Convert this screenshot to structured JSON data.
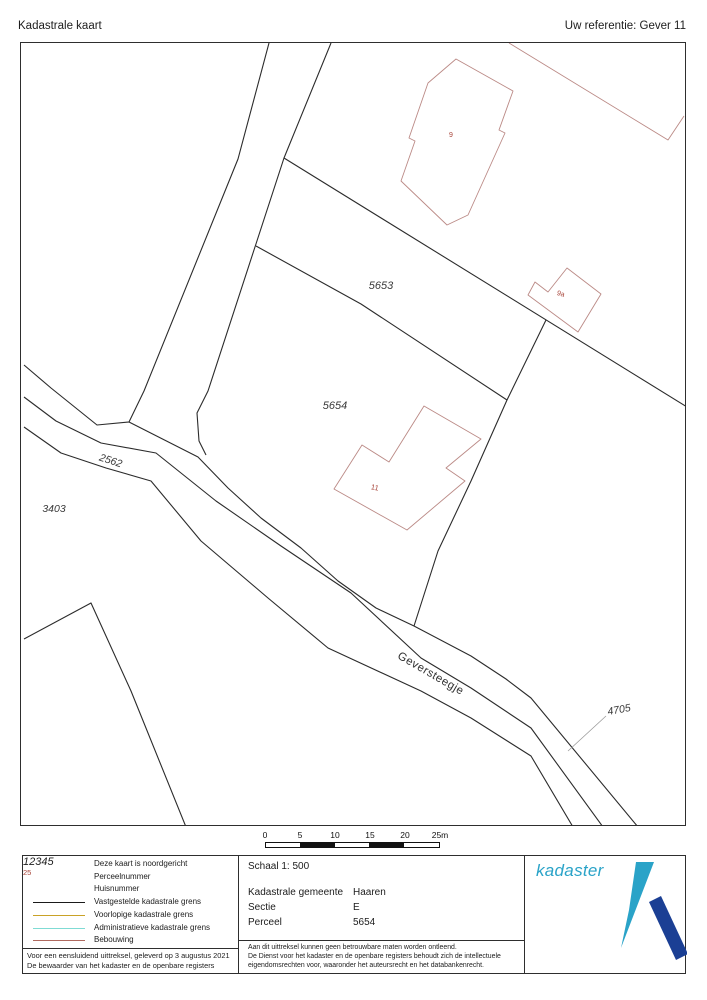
{
  "page": {
    "title": "Kadastrale kaart",
    "reference": "Uw referentie: Gever 11"
  },
  "map": {
    "parcels": {
      "p5653": "5653",
      "p5654": "5654",
      "p2562": "2562",
      "p3403": "3403",
      "p4705": "4705"
    },
    "house_numbers": {
      "h9": "9",
      "h9a": "9a",
      "h11": "11"
    },
    "street": "Geversteegje"
  },
  "scalebar": {
    "ticks": [
      "0",
      "5",
      "10",
      "15",
      "20",
      "25m"
    ]
  },
  "legend": {
    "north_note": "Deze kaart is noordgericht",
    "items": [
      {
        "symbol": "12345",
        "label": "Perceelnummer"
      },
      {
        "symbol": "25",
        "label": "Huisnummer"
      },
      {
        "swatch": "#1a1a1a",
        "label": "Vastgestelde kadastrale grens"
      },
      {
        "swatch": "#c9a227",
        "label": "Voorlopige kadastrale grens"
      },
      {
        "swatch": "#7fdbd4",
        "label": "Administratieve kadastrale grens"
      },
      {
        "swatch": "#b06a5f",
        "label": "Bebouwing"
      }
    ],
    "footer_line1": "Voor een eensluidend uittreksel, geleverd op 3 augustus 2021",
    "footer_line2": "De bewaarder van het kadaster en de openbare registers"
  },
  "details": {
    "scale_label": "Schaal 1: 500",
    "rows": [
      {
        "label": "Kadastrale gemeente",
        "value": "Haaren"
      },
      {
        "label": "Sectie",
        "value": "E"
      },
      {
        "label": "Perceel",
        "value": "5654"
      }
    ],
    "disclaimer": [
      "Aan dit uittreksel kunnen geen betrouwbare maten worden ontleend.",
      "De Dienst voor het kadaster en de openbare registers behoudt zich de intellectuele",
      "eigendomsrechten voor, waaronder het auteursrecht en het databankenrecht."
    ]
  },
  "logo": {
    "text": "kadaster",
    "light_blue": "#2aa3c8",
    "dark_blue": "#1b3f94"
  },
  "colors": {
    "boundary": "#2b2b2b",
    "building": "#bb8a86",
    "house_number": "#a8453a",
    "parcel_label": "#3a3a3a"
  }
}
